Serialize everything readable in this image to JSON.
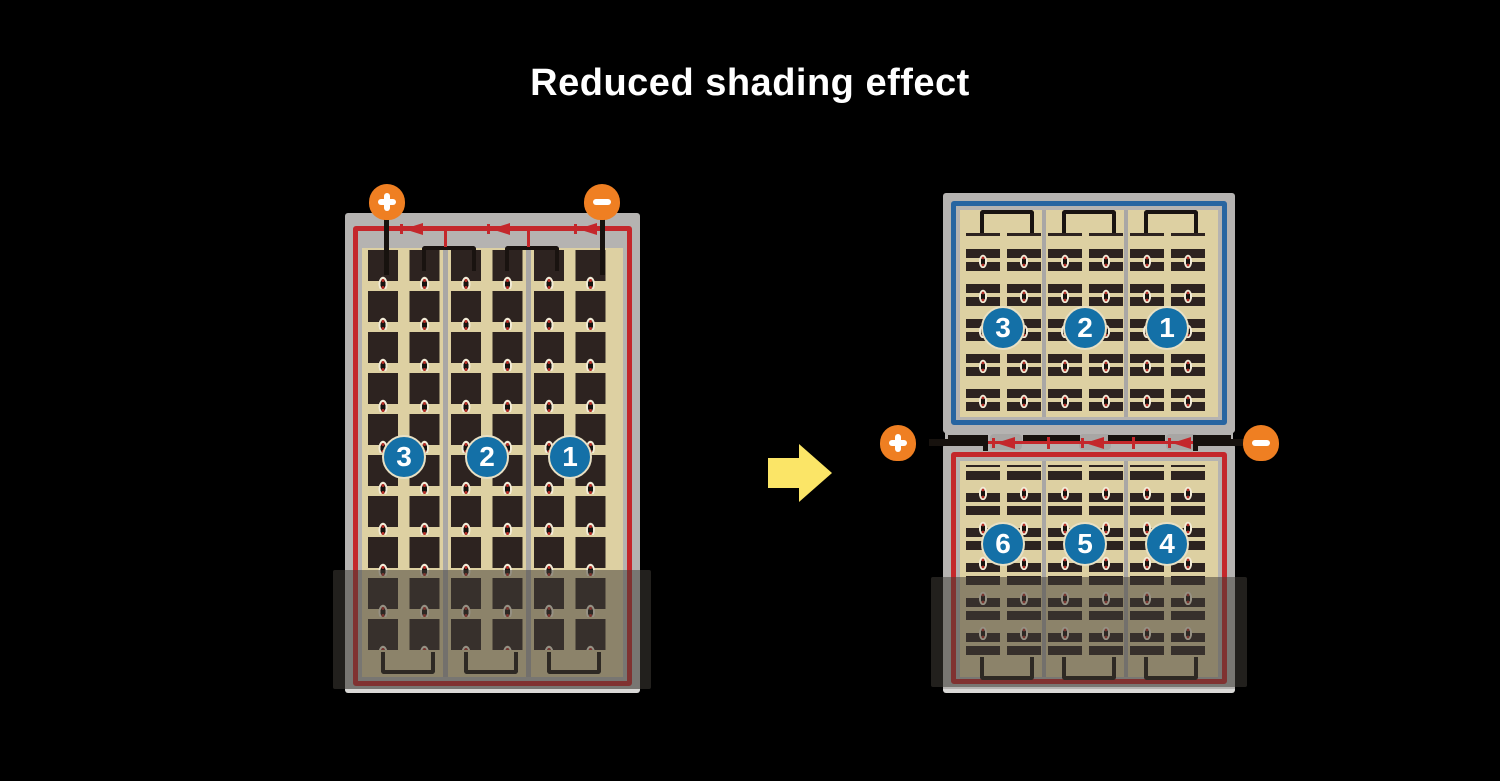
{
  "title": "Reduced shading effect",
  "colors": {
    "background": "#000000",
    "title_text": "#ffffff",
    "frame_gray": "#b5b3b1",
    "cell_tan": "#ddd0a2",
    "cell_dark": "#2d2320",
    "circuit_red": "#c4272b",
    "circuit_blue": "#2765a1",
    "terminal_orange": "#ef7f22",
    "badge_blue": "#1470a7",
    "arrow_yellow": "#fbe567"
  },
  "left_module": {
    "terminals": {
      "positive": "+",
      "negative": "−"
    },
    "string_labels": [
      "3",
      "2",
      "1"
    ]
  },
  "right_module": {
    "terminals": {
      "positive": "+",
      "negative": "−"
    },
    "top_string_labels": [
      "3",
      "2",
      "1"
    ],
    "bottom_string_labels": [
      "6",
      "5",
      "4"
    ]
  }
}
